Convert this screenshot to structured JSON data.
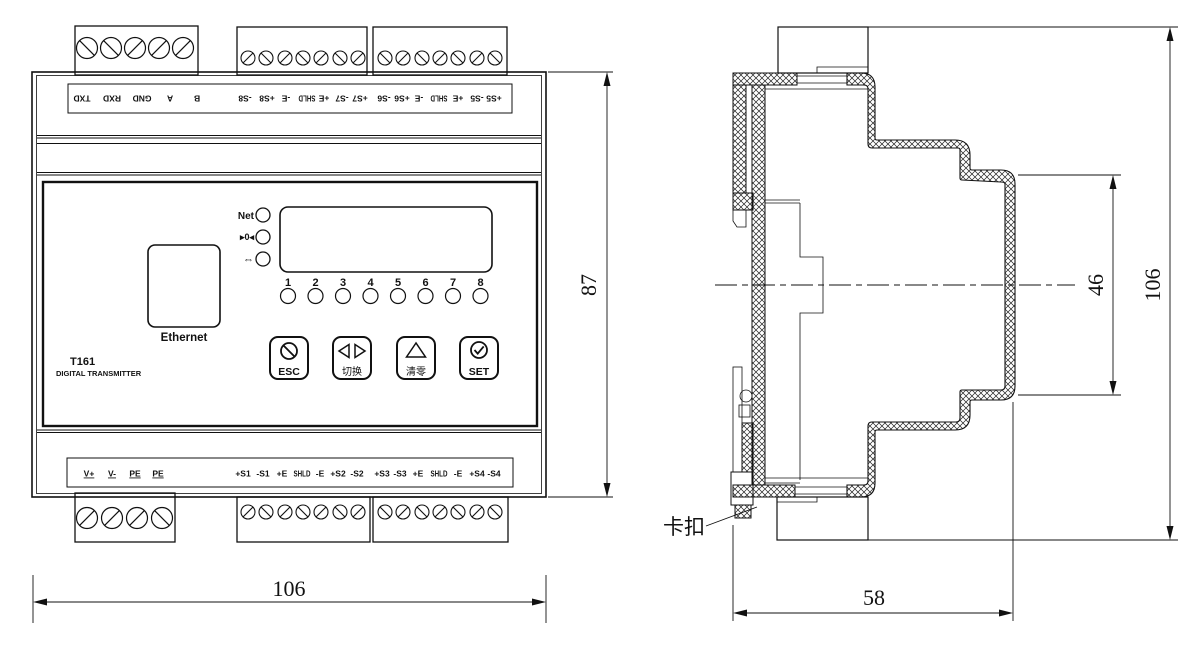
{
  "front_view": {
    "model": "T161",
    "subtitle": "DIGITAL TRANSMITTER",
    "ethernet_label": "Ethernet",
    "leds": {
      "net": "Net",
      "comm": "▸0◂",
      "link": "⇔"
    },
    "channels": [
      "1",
      "2",
      "3",
      "4",
      "5",
      "6",
      "7",
      "8"
    ],
    "buttons": {
      "esc": "ESC",
      "switch": "切换",
      "clear": "清零",
      "set": "SET"
    },
    "top_terminals": [
      "TXD",
      "RXD",
      "GND",
      "A",
      "B",
      "-S8",
      "+S8",
      "-E",
      "SHLD",
      "+E",
      "-S7",
      "+S7",
      "-S6",
      "+S6",
      "-E",
      "SHLD",
      "+E",
      "-S5",
      "+S5"
    ],
    "bottom_terminals": [
      "V+",
      "V-",
      "PE",
      "PE",
      "+S1",
      "-S1",
      "+E",
      "SHLD",
      "-E",
      "+S2",
      "-S2",
      "+S3",
      "-S3",
      "+E",
      "SHLD",
      "-E",
      "+S4",
      "-S4"
    ],
    "dims": {
      "height": "87",
      "width": "106"
    }
  },
  "side_view": {
    "dims": {
      "front_face_height": "46",
      "total_height": "106",
      "depth": "58"
    },
    "clip_label": "卡扣"
  }
}
